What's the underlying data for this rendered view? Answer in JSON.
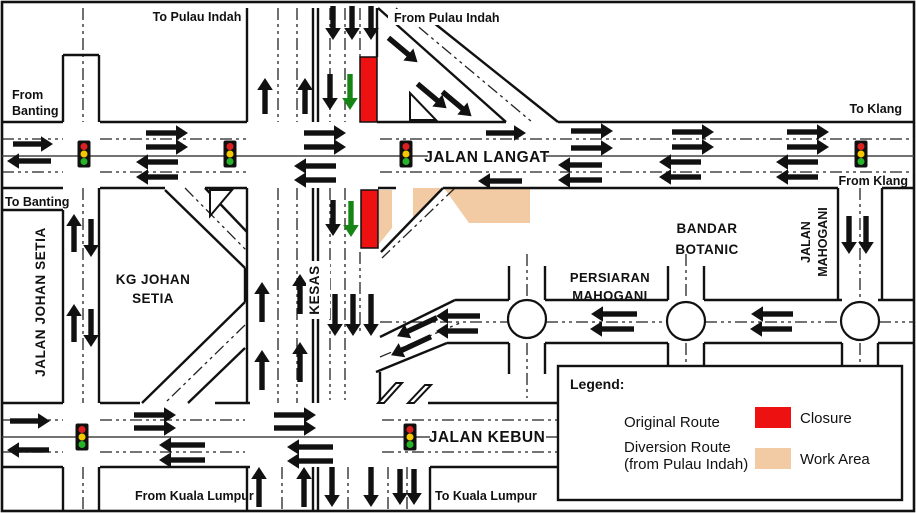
{
  "labels": {
    "to_pulau_indah": "To Pulau Indah",
    "from_pulau_indah": "From Pulau Indah",
    "from_banting_1": "From",
    "from_banting_2": "Banting",
    "to_banting": "To Banting",
    "to_klang": "To Klang",
    "from_klang": "From Klang",
    "jalan_langat": "JALAN LANGAT",
    "jalan_johan_setia": "JALAN JOHAN SETIA",
    "kg_johan_setia_1": "KG JOHAN",
    "kg_johan_setia_2": "SETIA",
    "kesas": "KESAS",
    "bandar_botanic_1": "BANDAR",
    "bandar_botanic_2": "BOTANIC",
    "persiaran_mahogani_1": "PERSIARAN",
    "persiaran_mahogani_2": "MAHOGANI",
    "jalan_mahogani_1": "JALAN",
    "jalan_mahogani_2": "MAHOGANI",
    "jalan_kebun": "JALAN KEBUN",
    "from_kuala_lumpur": "From Kuala Lumpur",
    "to_kuala_lumpur": "To Kuala Lumpur"
  },
  "legend": {
    "title": "Legend:",
    "original_route": "Original Route",
    "diversion_route_1": "Diversion Route",
    "diversion_route_2": "(from Pulau Indah)",
    "closure": "Closure",
    "work_area": "Work Area"
  },
  "colors": {
    "route_black": "#111111",
    "diversion_green": "#168516",
    "closure_red": "#ee1111",
    "work_area_tan": "#f2cba4",
    "light_red": "#dd2020",
    "light_yellow": "#f6c800",
    "light_green": "#28b428"
  },
  "traffic_lights": [
    [
      84,
      154
    ],
    [
      230,
      154
    ],
    [
      406,
      154
    ],
    [
      861,
      154
    ],
    [
      82,
      437
    ],
    [
      410,
      437
    ]
  ],
  "roundabouts": [
    [
      527,
      319
    ],
    [
      686,
      321
    ],
    [
      860,
      321
    ]
  ],
  "closure_rects": [
    [
      360,
      57,
      17,
      65
    ],
    [
      361,
      190,
      17,
      58
    ]
  ],
  "work_area_polys": [
    "379,190 392,190 392,228 379,244",
    "413,188 441,188 413,219",
    "444,188 530,188 530,223 469,223"
  ],
  "arrows": [
    [
      33,
      144,
      0,
      40,
      "b"
    ],
    [
      167,
      133,
      0,
      42,
      "b"
    ],
    [
      167,
      147,
      0,
      42,
      "b"
    ],
    [
      325,
      133,
      0,
      42,
      "b"
    ],
    [
      325,
      147,
      0,
      42,
      "b"
    ],
    [
      506,
      133,
      0,
      40,
      "b"
    ],
    [
      592,
      131,
      0,
      42,
      "b"
    ],
    [
      592,
      148,
      0,
      42,
      "b"
    ],
    [
      693,
      132,
      0,
      42,
      "b"
    ],
    [
      693,
      147,
      0,
      42,
      "b"
    ],
    [
      808,
      132,
      0,
      42,
      "b"
    ],
    [
      808,
      147,
      0,
      42,
      "b"
    ],
    [
      29,
      161,
      180,
      44,
      "b"
    ],
    [
      157,
      162,
      180,
      42,
      "b"
    ],
    [
      157,
      177,
      180,
      42,
      "b"
    ],
    [
      315,
      166,
      180,
      42,
      "b"
    ],
    [
      315,
      180,
      180,
      42,
      "b"
    ],
    [
      500,
      181,
      180,
      44,
      "b"
    ],
    [
      580,
      165,
      180,
      44,
      "b"
    ],
    [
      580,
      180,
      180,
      44,
      "b"
    ],
    [
      680,
      162,
      180,
      42,
      "b"
    ],
    [
      680,
      177,
      180,
      42,
      "b"
    ],
    [
      797,
      162,
      180,
      42,
      "b"
    ],
    [
      797,
      177,
      180,
      42,
      "b"
    ],
    [
      333,
      23,
      90,
      34,
      "b"
    ],
    [
      352,
      23,
      90,
      34,
      "b"
    ],
    [
      371,
      23,
      90,
      34,
      "b"
    ],
    [
      330,
      92,
      90,
      36,
      "b"
    ],
    [
      350,
      92,
      90,
      36,
      "g"
    ],
    [
      265,
      96,
      270,
      36,
      "b"
    ],
    [
      305,
      96,
      270,
      36,
      "b"
    ],
    [
      333,
      218,
      90,
      36,
      "b"
    ],
    [
      351,
      219,
      90,
      36,
      "g"
    ],
    [
      335,
      315,
      90,
      42,
      "b"
    ],
    [
      353,
      315,
      90,
      42,
      "b"
    ],
    [
      371,
      315,
      90,
      42,
      "b"
    ],
    [
      262,
      302,
      270,
      40,
      "b"
    ],
    [
      300,
      294,
      270,
      40,
      "b"
    ],
    [
      262,
      370,
      270,
      40,
      "b"
    ],
    [
      300,
      362,
      270,
      40,
      "b"
    ],
    [
      259,
      487,
      270,
      40,
      "b"
    ],
    [
      304,
      487,
      270,
      40,
      "b"
    ],
    [
      332,
      487,
      90,
      40,
      "b"
    ],
    [
      371,
      487,
      90,
      40,
      "b"
    ],
    [
      400,
      487,
      90,
      36,
      "b"
    ],
    [
      414,
      487,
      90,
      36,
      "b"
    ],
    [
      74,
      233,
      270,
      38,
      "b"
    ],
    [
      91,
      238,
      90,
      38,
      "b"
    ],
    [
      74,
      323,
      270,
      38,
      "b"
    ],
    [
      91,
      328,
      90,
      38,
      "b"
    ],
    [
      403,
      50,
      40,
      38,
      "b"
    ],
    [
      432,
      96,
      40,
      38,
      "b"
    ],
    [
      457,
      104,
      40,
      38,
      "b"
    ],
    [
      417,
      327,
      155,
      44,
      "b"
    ],
    [
      411,
      346,
      155,
      44,
      "b"
    ],
    [
      458,
      316,
      180,
      44,
      "b"
    ],
    [
      457,
      331,
      180,
      42,
      "b"
    ],
    [
      614,
      314,
      180,
      46,
      "b"
    ],
    [
      612,
      329,
      180,
      44,
      "b"
    ],
    [
      772,
      314,
      180,
      42,
      "b"
    ],
    [
      771,
      329,
      180,
      42,
      "b"
    ],
    [
      849,
      235,
      90,
      38,
      "b"
    ],
    [
      866,
      235,
      90,
      38,
      "b"
    ],
    [
      30,
      421,
      0,
      40,
      "b"
    ],
    [
      155,
      415,
      0,
      42,
      "b"
    ],
    [
      155,
      428,
      0,
      42,
      "b"
    ],
    [
      295,
      415,
      0,
      42,
      "b"
    ],
    [
      295,
      428,
      0,
      42,
      "b"
    ],
    [
      28,
      450,
      180,
      42,
      "b"
    ],
    [
      182,
      445,
      180,
      46,
      "b"
    ],
    [
      182,
      460,
      180,
      46,
      "b"
    ],
    [
      310,
      447,
      180,
      46,
      "b"
    ],
    [
      310,
      461,
      180,
      46,
      "b"
    ],
    [
      594,
      421,
      0,
      44,
      "b"
    ],
    [
      594,
      457,
      0,
      44,
      "g"
    ]
  ]
}
